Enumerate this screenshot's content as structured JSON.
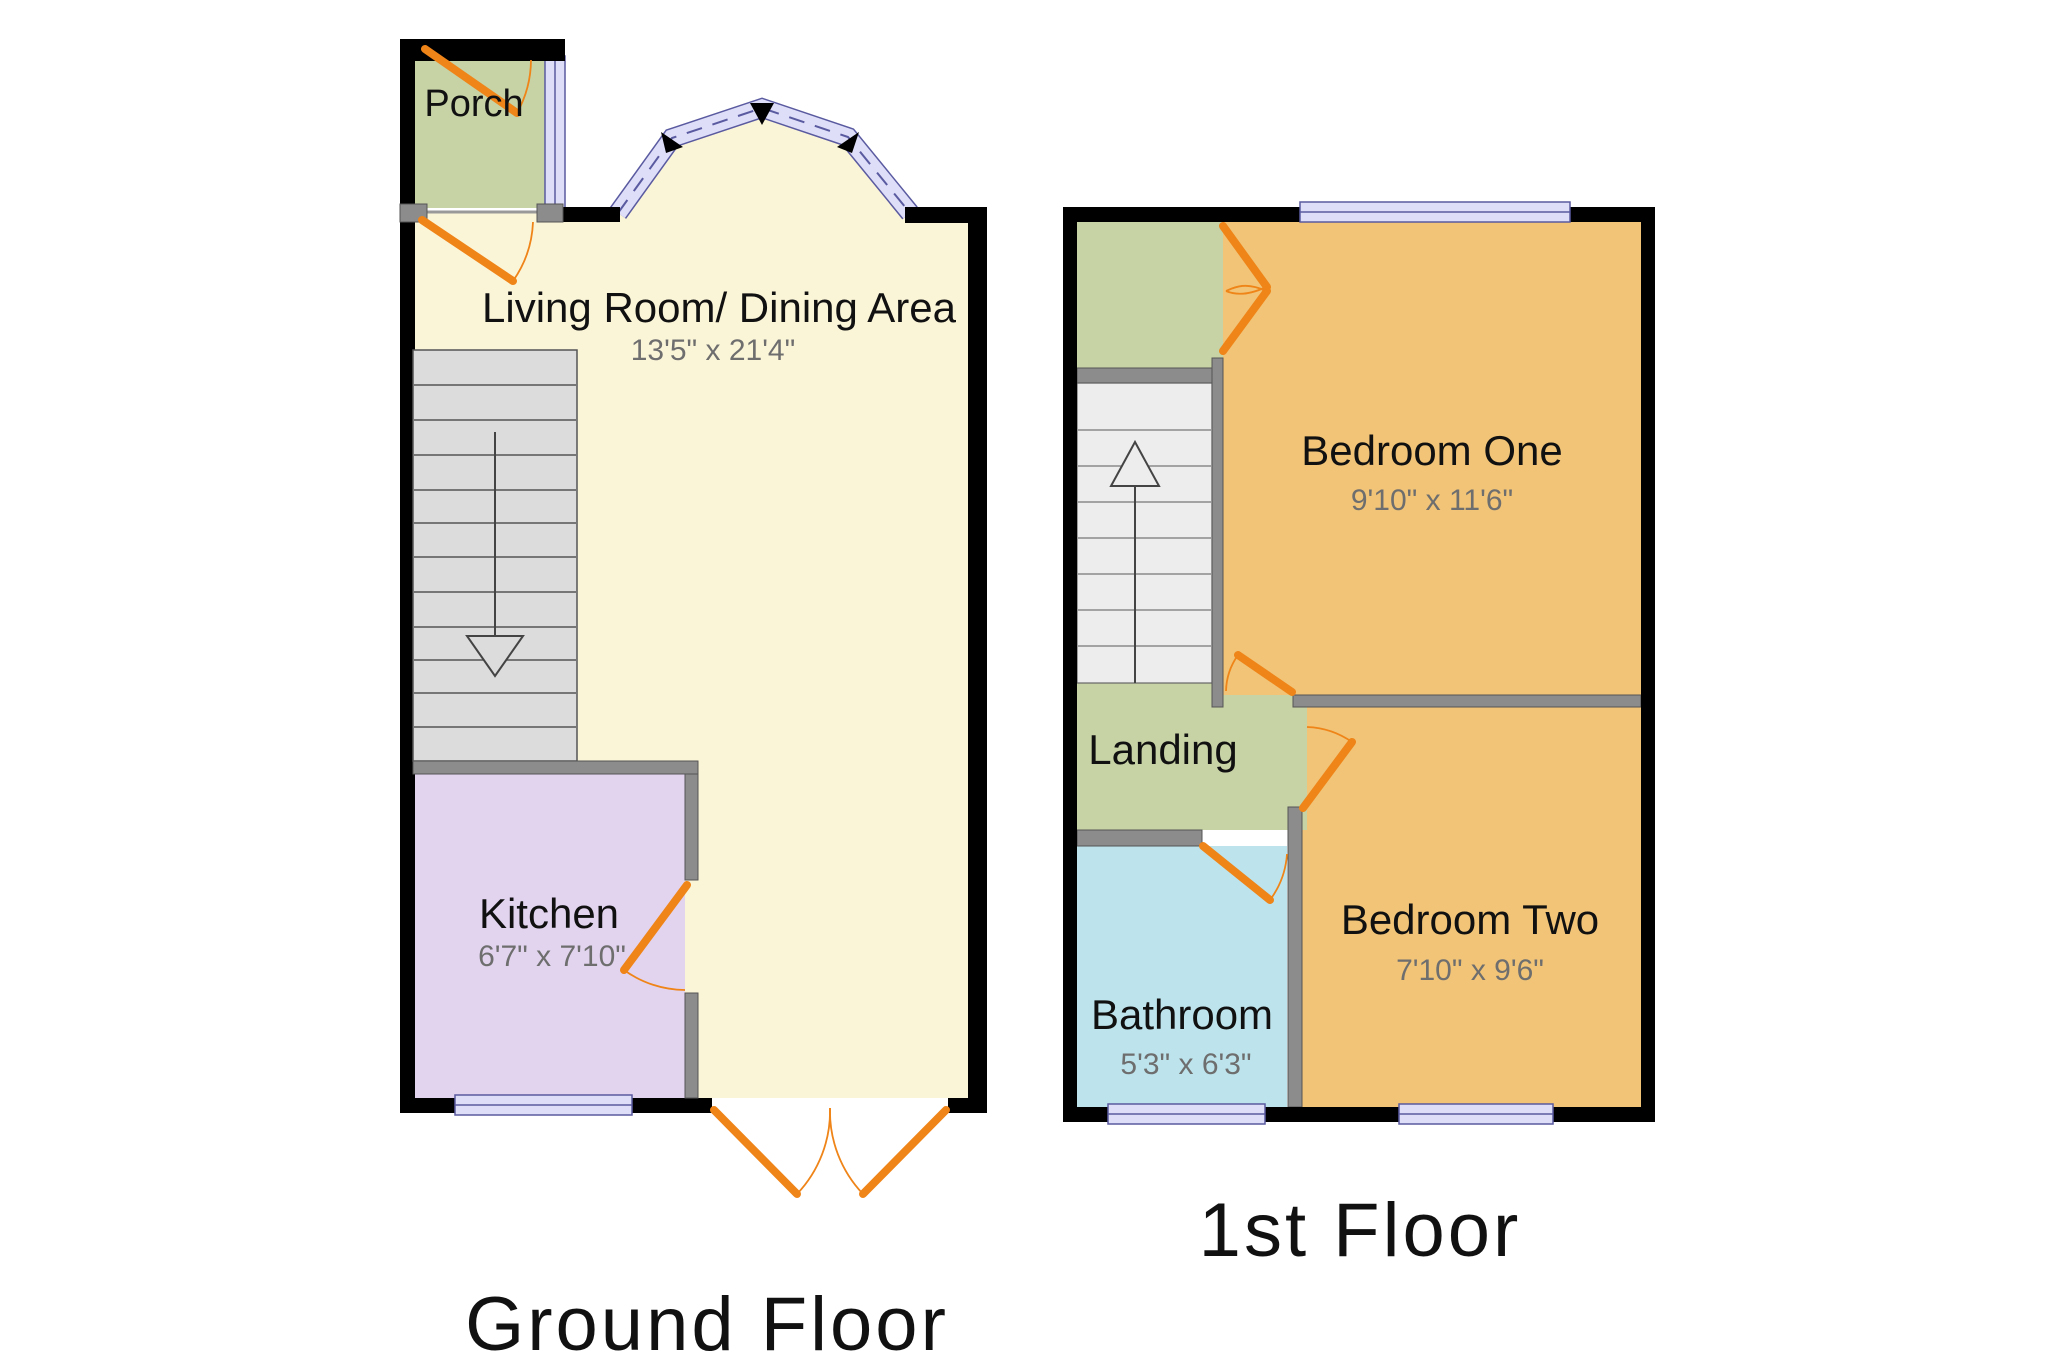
{
  "ground_floor": {
    "caption": "Ground Floor",
    "rooms": {
      "porch": {
        "name": "Porch"
      },
      "living": {
        "name": "Living Room/ Dining Area",
        "dimensions": "13'5\" x 21'4\""
      },
      "kitchen": {
        "name": "Kitchen",
        "dimensions": "6'7\" x 7'10\""
      }
    }
  },
  "first_floor": {
    "caption": "1st Floor",
    "rooms": {
      "bedroom_one": {
        "name": "Bedroom One",
        "dimensions": "9'10\" x 11'6\""
      },
      "bedroom_two": {
        "name": "Bedroom Two",
        "dimensions": "7'10\" x 9'6\""
      },
      "bathroom": {
        "name": "Bathroom",
        "dimensions": "5'3\" x 6'3\""
      },
      "landing": {
        "name": "Landing"
      }
    }
  },
  "colors": {
    "living": "#FBF5D8",
    "green": "#C7D2A5",
    "kitchen": "#E2D4EF",
    "bedroom": "#F1C477",
    "bathroom": "#BDE4EC",
    "window_fill": "#DEDEF9",
    "window_stroke": "#5A5AA0",
    "door": "#EF8418",
    "wall": "#000000",
    "inner_wall": "#8C8C8C",
    "stairs_ground": "#DCDCDC",
    "stairs_first": "#EDEDED"
  }
}
